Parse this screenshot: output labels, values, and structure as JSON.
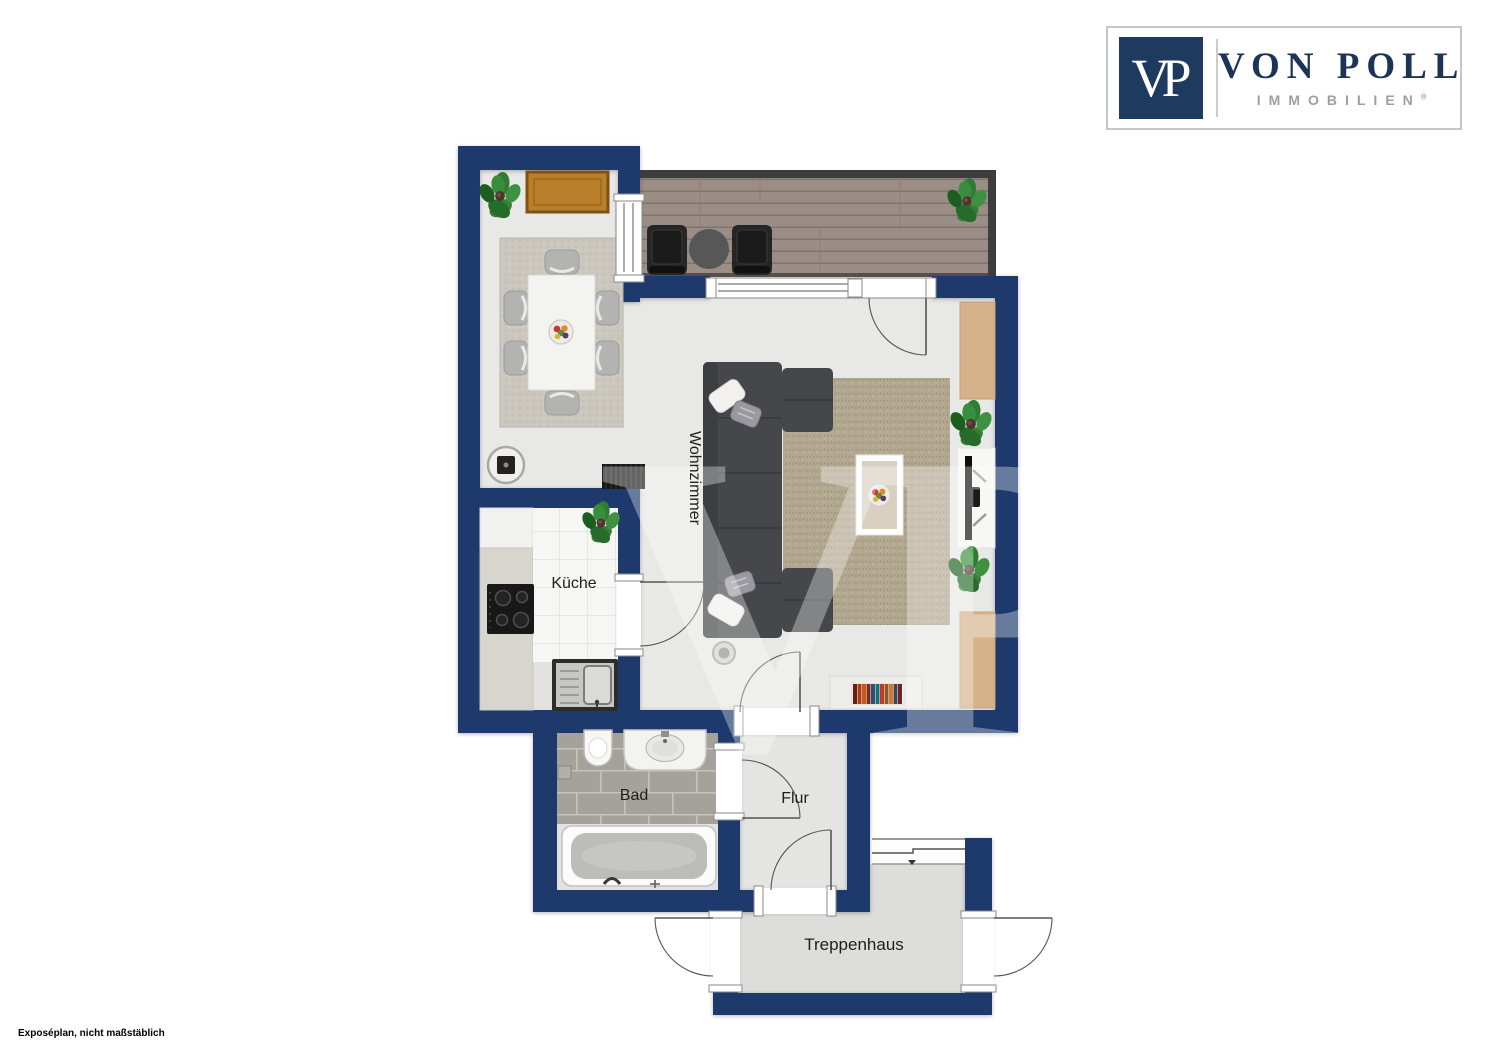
{
  "logo": {
    "monogram": "VP",
    "name": "VON POLL",
    "subtitle": "IMMOBILIEN",
    "registered": "®"
  },
  "rooms": {
    "wohnzimmer": {
      "label": "Wohnzimmer"
    },
    "kueche": {
      "label": "Küche"
    },
    "bad": {
      "label": "Bad"
    },
    "flur": {
      "label": "Flur"
    },
    "treppenhaus": {
      "label": "Treppenhaus"
    }
  },
  "watermark": {
    "text": "VP"
  },
  "footer": {
    "note": "Exposéplan, nicht maßstäblich"
  },
  "colors": {
    "wall_navy": "#1e3a6d",
    "logo_navy": "#1e3a5f",
    "logo_text_navy": "#1c3456",
    "logo_gray": "#9aa0a6",
    "deck_frame": "#3d3d3d",
    "wood_accent": "#d5b28a",
    "floor_gray": "#e8e8e6"
  }
}
